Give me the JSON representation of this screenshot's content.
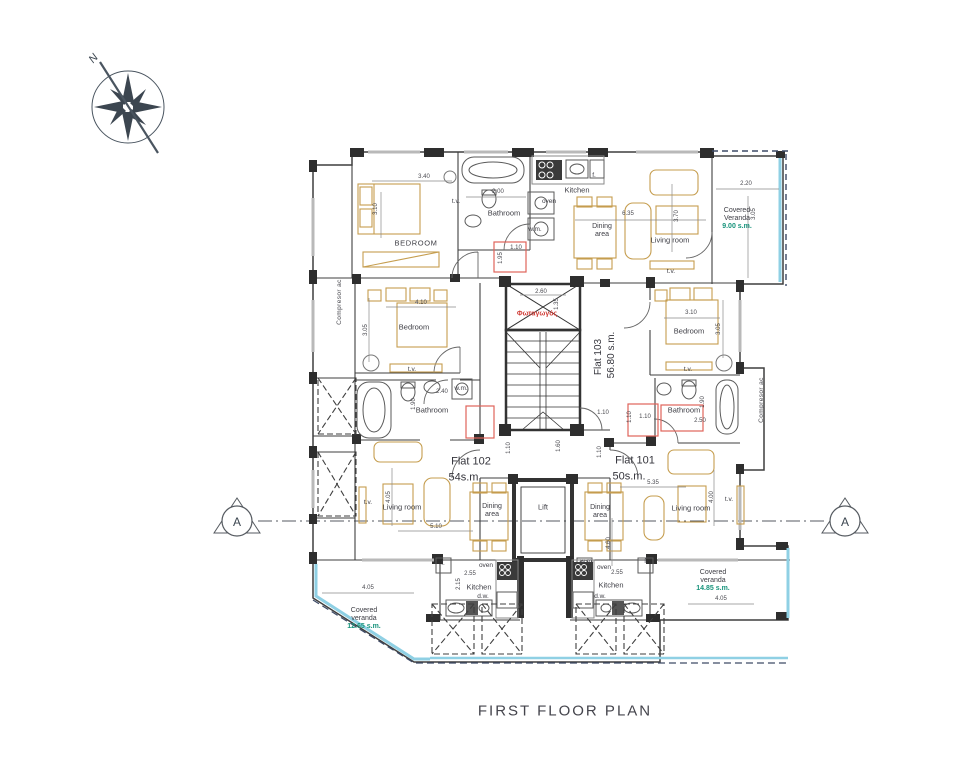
{
  "meta": {
    "title": "FIRST FLOOR PLAN"
  },
  "compass": {
    "north": "N"
  },
  "section": {
    "marker": "A"
  },
  "flats": {
    "f101": {
      "name": "Flat 101",
      "area": "50s.m."
    },
    "f102": {
      "name": "Flat 102",
      "area": "54s.m."
    },
    "f103": {
      "name": "Flat 103",
      "area": "56.80 s.m."
    }
  },
  "rooms": {
    "bedroom_upper": "BEDROOM",
    "bedroom": "Bedroom",
    "bathroom": "Bathroom",
    "kitchen": "Kitchen",
    "dining1": "Dining",
    "dining2": "area",
    "living": "Living room",
    "lift": "Lift",
    "lightwell": "Φωταγωγός",
    "compressor": "Compresor ac"
  },
  "fixtures": {
    "tv": "t.v.",
    "wm": "w.m.",
    "oven": "oven",
    "fridge": "f.",
    "dw": "d.w."
  },
  "verandas": {
    "top": {
      "line1": "Covered",
      "line2": "Veranda",
      "area": "9.00 s.m."
    },
    "right": {
      "line1": "Covered",
      "line2": "veranda",
      "area": "14.85 s.m."
    },
    "left": {
      "line1": "Covered",
      "line2": "veranda",
      "area": "12.65 s.m."
    }
  },
  "dims": {
    "d110": "1.10",
    "d135": "1.35",
    "d160": "1.60",
    "d190": "1.90",
    "d195": "1.95",
    "d200": "2.00",
    "d215": "2.15",
    "d220": "2.20",
    "d240": "2.40",
    "d250": "2.50",
    "d255": "2.55",
    "d260": "2.60",
    "d305": "3.05",
    "d310": "3.10",
    "d340": "3.40",
    "d370": "3.70",
    "d400": "4.00",
    "d405": "4.05",
    "d410": "4.10",
    "d460": "4.60",
    "d510": "5.10",
    "d535": "5.35",
    "d635": "6.35"
  },
  "colors": {
    "wall": "#3f3f3f",
    "furniture": "#c59d4e",
    "veranda_edge": "#8fd0e4",
    "area_text": "#17937b",
    "red_accent": "#e0635a",
    "red_text": "#cf3b35"
  }
}
